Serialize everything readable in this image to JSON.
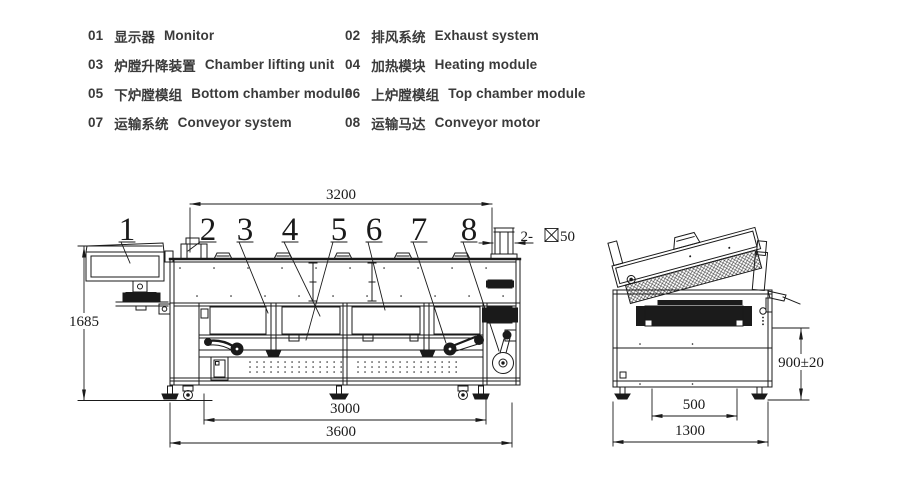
{
  "legend": {
    "items": [
      {
        "num": "01",
        "zh": "显示器",
        "en": "Monitor"
      },
      {
        "num": "02",
        "zh": "排风系统",
        "en": "Exhaust system"
      },
      {
        "num": "03",
        "zh": "炉膛升降装置",
        "en": "Chamber lifting unit"
      },
      {
        "num": "04",
        "zh": "加热模块",
        "en": "Heating module"
      },
      {
        "num": "05",
        "zh": "下炉膛模组",
        "en": "Bottom chamber module"
      },
      {
        "num": "06",
        "zh": "上炉膛模组",
        "en": "Top chamber module"
      },
      {
        "num": "07",
        "zh": "运输系统",
        "en": "Conveyor system"
      },
      {
        "num": "08",
        "zh": "运输马达",
        "en": "Conveyor motor"
      }
    ]
  },
  "callouts": {
    "c1": "1",
    "c2": "2",
    "c3": "3",
    "c4": "4",
    "c5": "5",
    "c6": "6",
    "c7": "7",
    "c8": "8"
  },
  "dimensions": {
    "top_width": "3200",
    "machine_height": "1685",
    "frame_width": "3000",
    "overall_length": "3600",
    "square_port_prefix": "2-",
    "square_port_size": "50",
    "end_inner_width": "500",
    "end_overall_width": "1300",
    "conveyor_height": "900±20"
  },
  "colors": {
    "line": "#1a1a1a",
    "text": "#3a3a3a"
  }
}
